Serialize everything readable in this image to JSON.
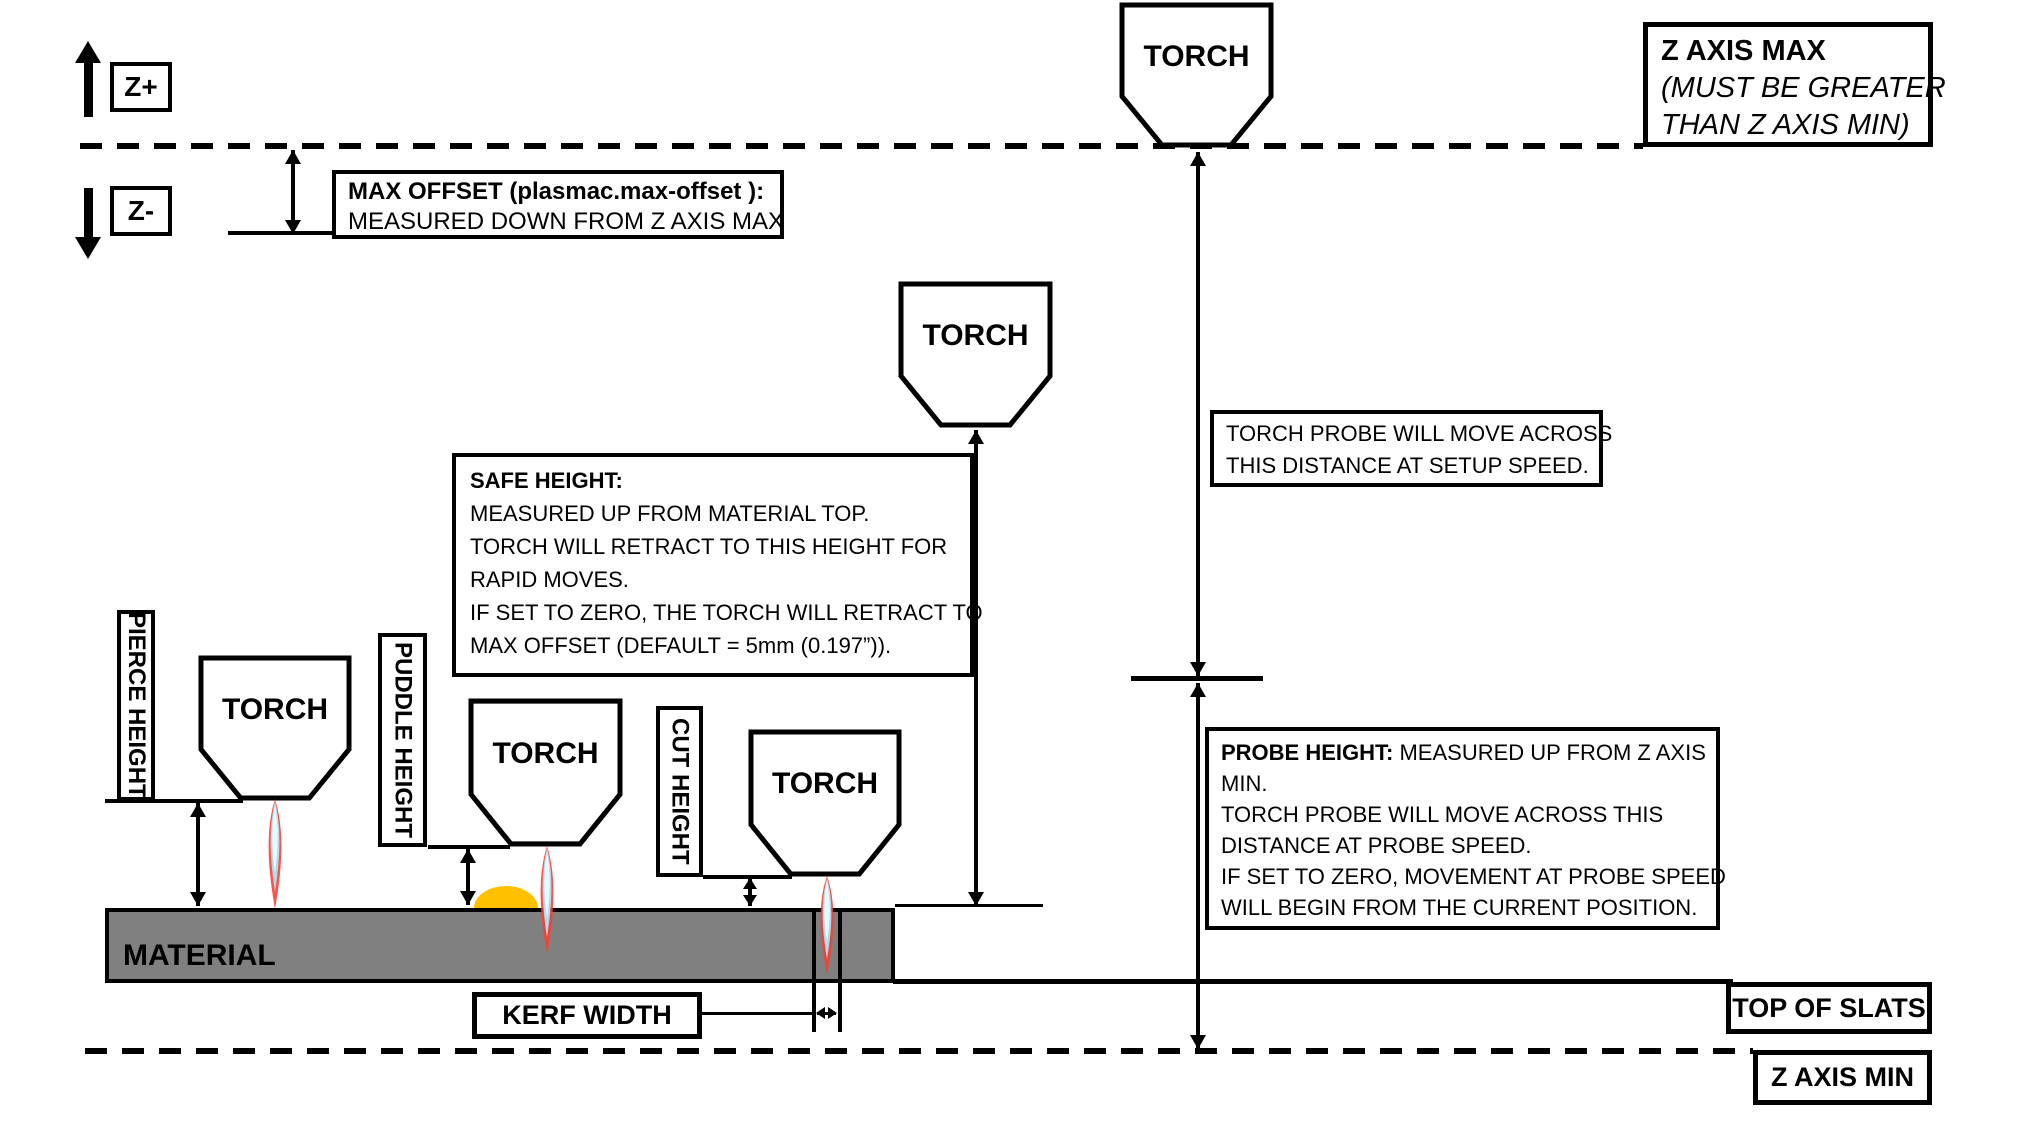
{
  "diagram": {
    "torch_label": "TORCH",
    "material_label": "MATERIAL",
    "z_plus_label": "Z+",
    "z_minus_label": "Z-",
    "z_axis_max": {
      "title": "Z AXIS MAX",
      "note_line1": "(MUST BE GREATER",
      "note_line2": "THAN Z AXIS MIN)"
    },
    "max_offset": {
      "title": "MAX OFFSET (plasmac.max-offset ):",
      "line2": "MEASURED DOWN FROM Z AXIS MAX"
    },
    "setup_note": {
      "line1": "TORCH PROBE WILL MOVE ACROSS",
      "line2": "THIS DISTANCE AT SETUP SPEED."
    },
    "safe_height": {
      "title": "SAFE HEIGHT:",
      "line2": "MEASURED UP FROM MATERIAL TOP.",
      "line3": "TORCH WILL RETRACT TO THIS HEIGHT FOR",
      "line4": "RAPID MOVES.",
      "line5": "IF SET TO ZERO, THE TORCH WILL RETRACT TO",
      "line6": "MAX OFFSET (DEFAULT = 5mm (0.197”))."
    },
    "probe_height": {
      "title": "PROBE HEIGHT:",
      "line1_rest": " MEASURED UP FROM Z AXIS",
      "line2": "MIN.",
      "line3": "TORCH PROBE WILL MOVE ACROSS THIS",
      "line4": "DISTANCE AT PROBE SPEED.",
      "line5": "IF SET TO ZERO,  MOVEMENT AT PROBE SPEED",
      "line6": "WILL BEGIN FROM THE CURRENT POSITION."
    },
    "pierce_height_label": "PIERCE HEIGHT",
    "puddle_height_label": "PUDDLE HEIGHT",
    "cut_height_label": "CUT HEIGHT",
    "kerf_width_label": "KERF WIDTH",
    "top_of_slats_label": "TOP OF SLATS",
    "z_axis_min_label": "Z AXIS MIN",
    "colors": {
      "line": "#000000",
      "material_fill": "#808080",
      "puddle": "#ffc000",
      "flame_outer": "#ff3b30",
      "flame_mid": "#aadded",
      "flame_core": "#e8f8fc"
    }
  }
}
